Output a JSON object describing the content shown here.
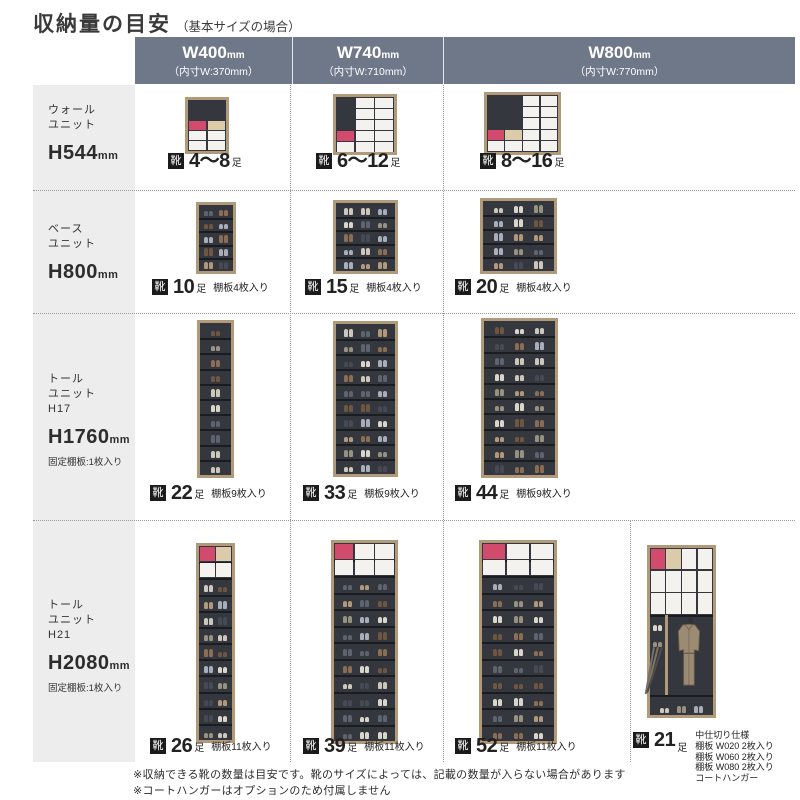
{
  "title": {
    "main": "収納量の目安",
    "sub": "（基本サイズの場合）"
  },
  "columns": [
    {
      "label": "W400",
      "unit": "mm",
      "inner": "（内寸W:370mm）"
    },
    {
      "label": "W740",
      "unit": "mm",
      "inner": "（内寸W:710mm）"
    },
    {
      "label": "W800",
      "unit": "mm",
      "inner": "（内寸W:770mm）"
    }
  ],
  "rows": [
    {
      "label": {
        "lines": [
          "ウォール",
          "ユニット"
        ],
        "height": "H544",
        "height_unit": "mm",
        "note": ""
      },
      "cells": [
        {
          "cap": {
            "chip": "靴",
            "count": "4〜8",
            "unit": "足",
            "note": ""
          },
          "art": {
            "kind": "boxstacks",
            "name": "wall-unit-w400",
            "maxRows": 5,
            "stacks": [
              [
                "white",
                "white",
                "pink"
              ],
              [
                "white",
                "white",
                "beige"
              ]
            ]
          }
        },
        {
          "cap": {
            "chip": "靴",
            "count": "6〜12",
            "unit": "足",
            "note": ""
          },
          "art": {
            "kind": "boxstacks",
            "name": "wall-unit-w740",
            "maxRows": 5,
            "stacks": [
              [
                "white",
                "pink"
              ],
              [
                "white",
                "white",
                "white",
                "white",
                "white"
              ],
              [
                "white",
                "white",
                "white",
                "white",
                "white"
              ]
            ]
          }
        },
        {
          "cap": {
            "chip": "靴",
            "count": "8〜16",
            "unit": "足",
            "note": ""
          },
          "art": {
            "kind": "boxstacks",
            "name": "wall-unit-w800",
            "maxRows": 5,
            "stacks": [
              [
                "white",
                "pink"
              ],
              [
                "white",
                "beige"
              ],
              [
                "white",
                "white",
                "white",
                "white",
                "white"
              ],
              [
                "white",
                "white",
                "white",
                "white",
                "white"
              ]
            ]
          }
        }
      ]
    },
    {
      "label": {
        "lines": [
          "ベース",
          "ユニット"
        ],
        "height": "H800",
        "height_unit": "mm",
        "note": ""
      },
      "cells": [
        {
          "cap": {
            "chip": "靴",
            "count": "10",
            "unit": "足",
            "note": "棚板4枚入り"
          },
          "art": {
            "kind": "shelves",
            "name": "base-unit-w400",
            "shelves": 4
          }
        },
        {
          "cap": {
            "chip": "靴",
            "count": "15",
            "unit": "足",
            "note": "棚板4枚入り"
          },
          "art": {
            "kind": "shelves",
            "name": "base-unit-w740",
            "shelves": 4
          }
        },
        {
          "cap": {
            "chip": "靴",
            "count": "20",
            "unit": "足",
            "note": "棚板4枚入り"
          },
          "art": {
            "kind": "shelves",
            "name": "base-unit-w800",
            "shelves": 4
          }
        }
      ]
    },
    {
      "label": {
        "lines": [
          "トール",
          "ユニット",
          "H17"
        ],
        "height": "H1760",
        "height_unit": "mm",
        "note": "固定棚板:1枚入り"
      },
      "cells": [
        {
          "cap": {
            "chip": "靴",
            "count": "22",
            "unit": "足",
            "note": "棚板9枚入り"
          },
          "art": {
            "kind": "shelves",
            "name": "tall-unit-h17-w400",
            "shelves": 9
          }
        },
        {
          "cap": {
            "chip": "靴",
            "count": "33",
            "unit": "足",
            "note": "棚板9枚入り"
          },
          "art": {
            "kind": "shelves",
            "name": "tall-unit-h17-w740",
            "shelves": 9
          }
        },
        {
          "cap": {
            "chip": "靴",
            "count": "44",
            "unit": "足",
            "note": "棚板9枚入り"
          },
          "art": {
            "kind": "shelves",
            "name": "tall-unit-h17-w800",
            "shelves": 9
          }
        }
      ]
    },
    {
      "label": {
        "lines": [
          "トール",
          "ユニット",
          "H21"
        ],
        "height": "H2080",
        "height_unit": "mm",
        "note": "固定棚板:1枚入り"
      },
      "cells": [
        {
          "cap": {
            "chip": "靴",
            "count": "26",
            "unit": "足",
            "note": "棚板11枚入り"
          },
          "art": {
            "kind": "boxshelves",
            "name": "tall-unit-h21-w400",
            "shelves": 11,
            "boxComps": 2,
            "boxGrid": [
              [
                "pink",
                "beige"
              ],
              [
                "white",
                "white"
              ]
            ]
          }
        },
        {
          "cap": {
            "chip": "靴",
            "count": "39",
            "unit": "足",
            "note": "棚板11枚入り"
          },
          "art": {
            "kind": "boxshelves",
            "name": "tall-unit-h21-w740",
            "shelves": 11,
            "boxComps": 2,
            "boxGrid": [
              [
                "pink",
                "white",
                "white"
              ],
              [
                "white",
                "white",
                "white"
              ]
            ]
          }
        },
        {
          "cap": {
            "chip": "靴",
            "count": "52",
            "unit": "足",
            "note": "棚板11枚入り"
          },
          "art": {
            "kind": "boxshelves",
            "name": "tall-unit-h21-w800",
            "shelves": 11,
            "boxComps": 2,
            "boxGrid": [
              [
                "pink",
                "white",
                "white"
              ],
              [
                "white",
                "white",
                "white"
              ]
            ]
          }
        },
        {
          "cap": {
            "chip": "靴",
            "count": "21",
            "unit": "足",
            "note": "",
            "note_lines": [
              "中仕切り仕様",
              "棚板 W020 2枚入り",
              "棚板 W060 2枚入り",
              "棚板 W080 2枚入り",
              "コートハンガー"
            ]
          },
          "art": {
            "kind": "coat",
            "name": "tall-unit-h21-divider-coat",
            "boxGrid": [
              [
                "pink",
                "beige",
                "white",
                "white"
              ],
              [
                "white",
                "white",
                "white",
                "white"
              ],
              [
                "white",
                "white",
                "white",
                "white"
              ]
            ]
          }
        }
      ]
    }
  ],
  "footnotes": [
    "※収納できる靴の数量は目安です。靴のサイズによっては、記載の数量が入らない場合があります",
    "※コートハンガーはオプションのため付属しません"
  ],
  "colors": {
    "header_bg": "#6f7889",
    "left_col_bg": "#ededed",
    "chip_bg": "#1b1b1b",
    "frame": "#b19a7a",
    "interior": "#34373d",
    "box_white": "#f4f2ee",
    "box_pink": "#d34b6c",
    "box_beige": "#dbcba9",
    "coat": "#9c8b73",
    "shoe_palette": [
      "#cdc6ba",
      "#97917f",
      "#5d6470",
      "#b2987a",
      "#454a55",
      "#d9d5cb",
      "#8a6d52",
      "#a7aeb9",
      "#6e5640"
    ]
  }
}
